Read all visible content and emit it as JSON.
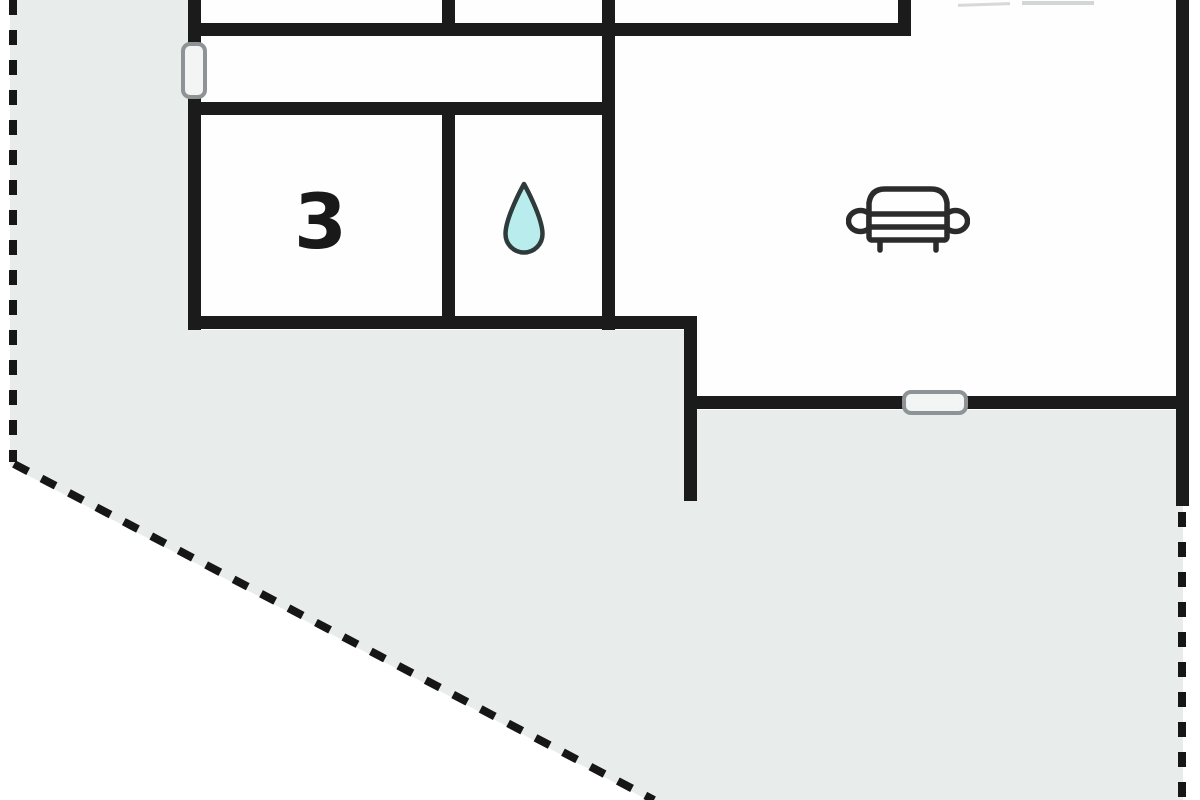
{
  "floorplan": {
    "room_label": "3",
    "rooms": {
      "numbered_room": "3",
      "bathroom_marker": "water-drop",
      "living_room_marker": "sofa"
    },
    "symbols": [
      "window-left-wall",
      "window-bottom-wall",
      "sofa",
      "water-drop"
    ],
    "boundary": "dashed-plot-line",
    "colors": {
      "background": "#ffffff",
      "plot_fill": "#e8ecea",
      "wall": "#1b1b1b",
      "room_fill": "#fdfefd",
      "window_border": "#8e9496",
      "window_fill": "#f3f5f4",
      "drop_fill": "#b9eded",
      "drop_outline": "#2f3b3b",
      "sofa_outline": "#2b2b2b",
      "label_color": "#191919"
    }
  }
}
